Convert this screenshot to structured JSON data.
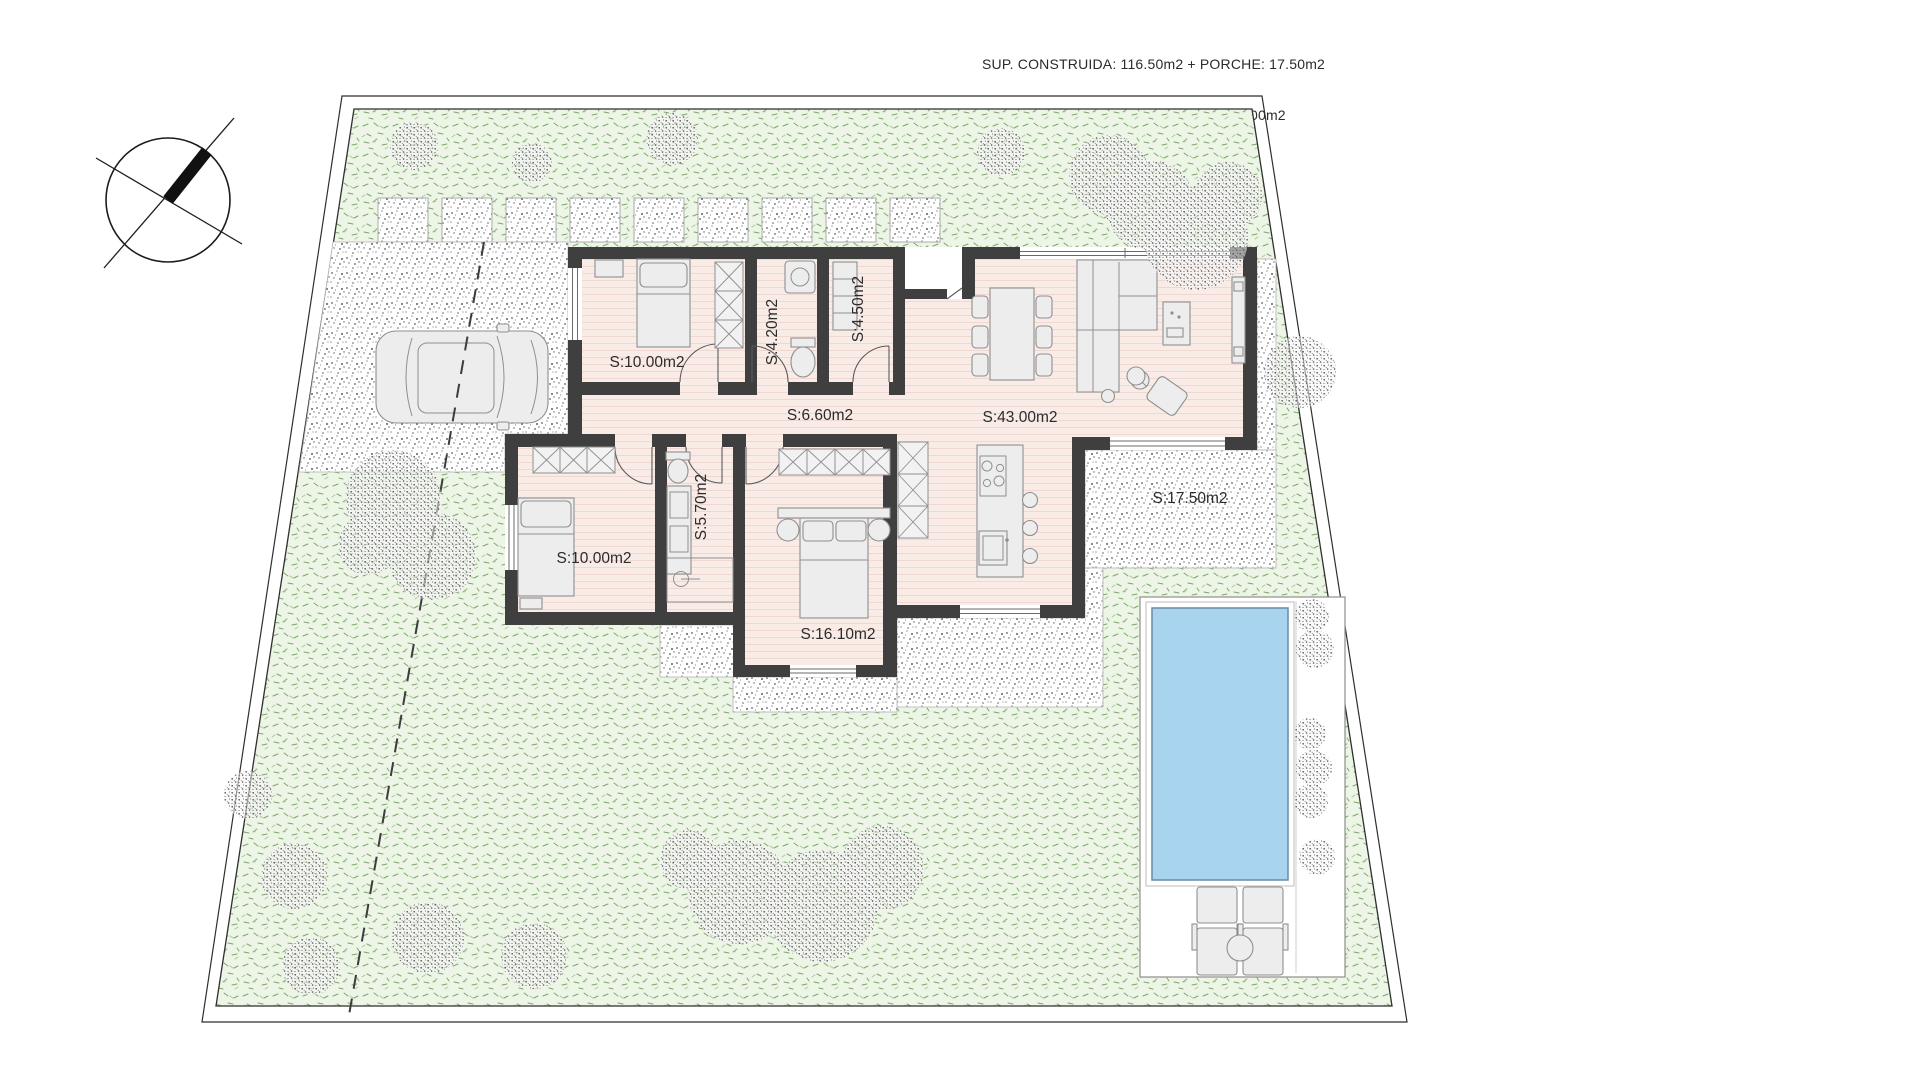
{
  "header": {
    "line1": "SUP. CONSTRUIDA: 116.50m2 + PORCHE: 17.50m2",
    "line2": "SUPERFICIE PLANTA BAJA TOTAL: 134.00m2"
  },
  "rooms": [
    {
      "name": "bedroom-1",
      "label": "S:10.00m2"
    },
    {
      "name": "bathroom-1",
      "label": "S:4.20m2"
    },
    {
      "name": "laundry-storage",
      "label": "S:4.50m2"
    },
    {
      "name": "hallway",
      "label": "S:6.60m2"
    },
    {
      "name": "living-dining-kitchen",
      "label": "S:43.00m2"
    },
    {
      "name": "bedroom-2",
      "label": "S:10.00m2"
    },
    {
      "name": "bathroom-2",
      "label": "S:5.70m2"
    },
    {
      "name": "master-bedroom",
      "label": "S:16.10m2"
    },
    {
      "name": "porch",
      "label": "S:17.50m2"
    }
  ],
  "site": {
    "features": [
      "north-compass",
      "plot-boundary",
      "lawn",
      "stepping-stone-path",
      "gravel-driveway",
      "car",
      "access-dashed-line",
      "swimming-pool",
      "pool-deck",
      "sun-loungers",
      "pool-side-table",
      "bushes",
      "trees",
      "porch-paving",
      "terrace-paving"
    ]
  },
  "colors": {
    "text": "#2b2b2b",
    "wall": "#3f3f3f",
    "boundary": "#2f2f2f",
    "lawn": "#edf5e7",
    "lawn_marks": "#7da76a",
    "floor": "#f9ece7",
    "floor_stripes": "#eed8d1",
    "pool_water": "#a8d4f0",
    "pool_edge": "#6f8fa8",
    "furniture": "#ededed"
  }
}
